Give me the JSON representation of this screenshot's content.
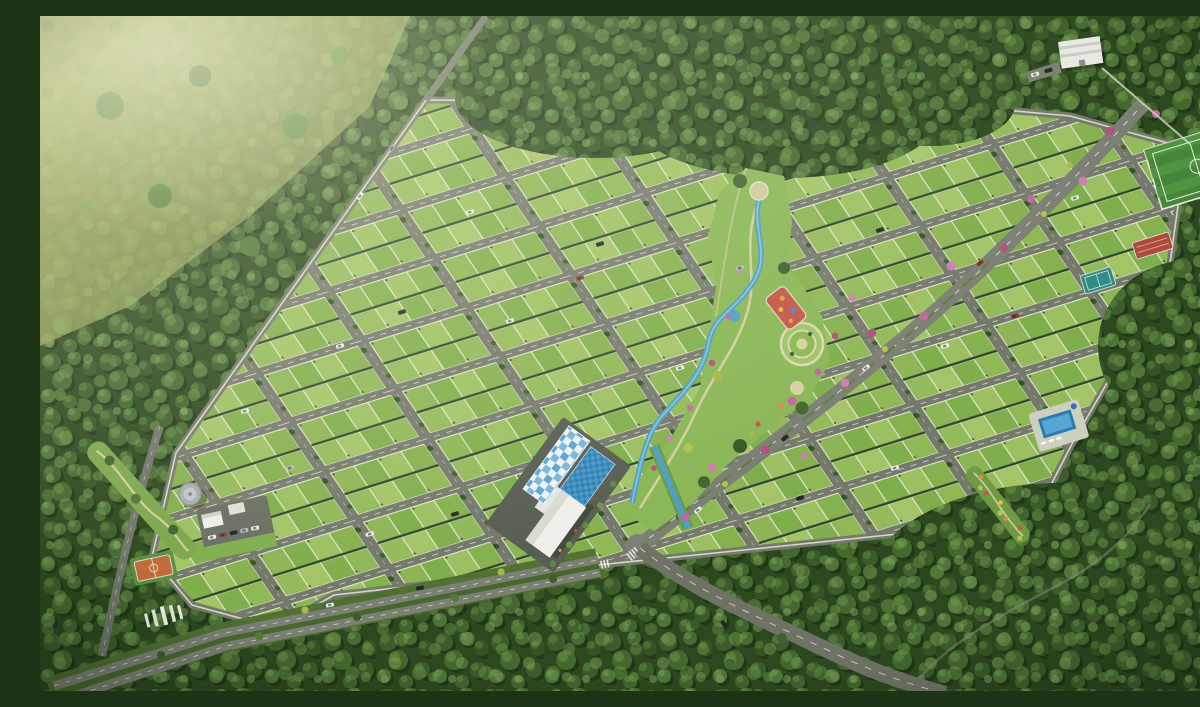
{
  "scene": {
    "title": "Aerial 3D render of a gated plotted township development with a diagonal grid of green plots, central linear park, flowering-tree boulevard and amenities, surrounded by dense forest",
    "view": "bird's-eye aerial perspective",
    "lighting": "warm hazy sunlight from the upper left",
    "setting": "forest clearing with open meadow at the top left"
  },
  "palette": {
    "forest-dark": "#2c481f",
    "forest-mid": "#3d5e2b",
    "forest-light": "#5d8440",
    "meadow": "#96a55b",
    "plot-green": "#84b04f",
    "plot-green-alt": "#9cc061",
    "road-gray": "#75796c",
    "wall-light": "#dde2cb",
    "water-blue": "#4f9fc4",
    "pool-blue": "#2b7cb4",
    "path-tan": "#d8d1a9",
    "flower-pink": "#bf699e",
    "playground-red": "#c2574a",
    "court-orange": "#c06a38",
    "track-red": "#b04a3e",
    "court-teal": "#2f8f86"
  },
  "elements": {
    "plot_grid": {
      "label": "plotted layout grid",
      "description": "diagonal avenues and cross streets forming blocks of two plot rows separated by dark hedges"
    },
    "central_park": {
      "label": "central linear park",
      "features": [
        "winding stream",
        "walking paths",
        "circular amphitheater plaza",
        "children playground",
        "flower beds"
      ]
    },
    "ne_boulevard": {
      "label": "main boulevard with pink flowering trees and palms"
    },
    "south_boulevard": {
      "label": "tree-lined dual carriageway along the southern edge"
    },
    "entry_road": {
      "label": "curving entry road from the forest"
    },
    "clubhouse": {
      "label": "clubhouse with blue checkered canopy and tiled pool court"
    },
    "swimming_pool": {
      "label": "swimming pool with deck"
    },
    "sports_field": {
      "label": "striped turf sports field"
    },
    "running_track": {
      "label": "red running track strip"
    },
    "teal_court": {
      "label": "teal sports court"
    },
    "basketball_court": {
      "label": "orange basketball court"
    },
    "water_tank": {
      "label": "overhead water tank"
    },
    "amenity_zone": {
      "label": "utility and parking zone"
    },
    "entrance_gate": {
      "label": "white entrance gate pylons"
    },
    "utility_building": {
      "label": "white utility building at top right"
    },
    "forest": {
      "label": "surrounding dense forest"
    },
    "meadow": {
      "label": "hazy open meadow"
    },
    "cars": {
      "label": "cars on roads",
      "approx_count": 26
    }
  }
}
